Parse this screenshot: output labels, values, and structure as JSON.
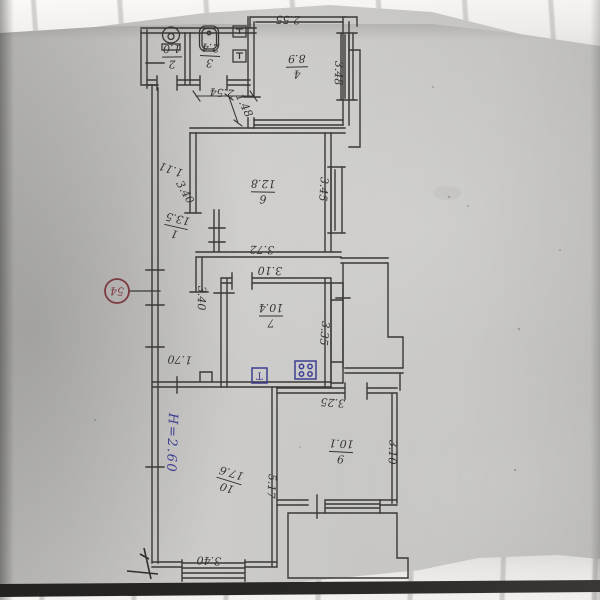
{
  "plan": {
    "apartment_number": "54",
    "ceiling_height": "H=2.60",
    "rooms": {
      "r1": {
        "num": "1",
        "area": "13.5"
      },
      "r2": {
        "num": "2",
        "area": "1.0"
      },
      "r3": {
        "num": "3",
        "area": "2.4"
      },
      "r4": {
        "num": "4",
        "area": "8.9"
      },
      "r6": {
        "num": "6",
        "area": "12.8"
      },
      "r7": {
        "num": "7",
        "area": "10.4"
      },
      "r9": {
        "num": "9",
        "area": "10.1"
      },
      "r10": {
        "num": "10",
        "area": "17.6"
      }
    },
    "dimensions": {
      "top_room4": "2.55",
      "room4_right": "3.48",
      "bath_bottom": "2.54",
      "hall_opening": "1.48",
      "hall_seg_a": "1.11",
      "hall_seg_b": "3.40",
      "room6_right": "3.45",
      "room6_bottom": "3.72",
      "hall_mid": "3.10",
      "hall_vert": "3.40",
      "room7_right": "3.35",
      "hall_lower": "1.70",
      "room9_top": "3.25",
      "room9_right": "3.10",
      "room10_right": "5.17",
      "room10_bottom": "3.40"
    },
    "symbols": {
      "phone": "T"
    }
  }
}
